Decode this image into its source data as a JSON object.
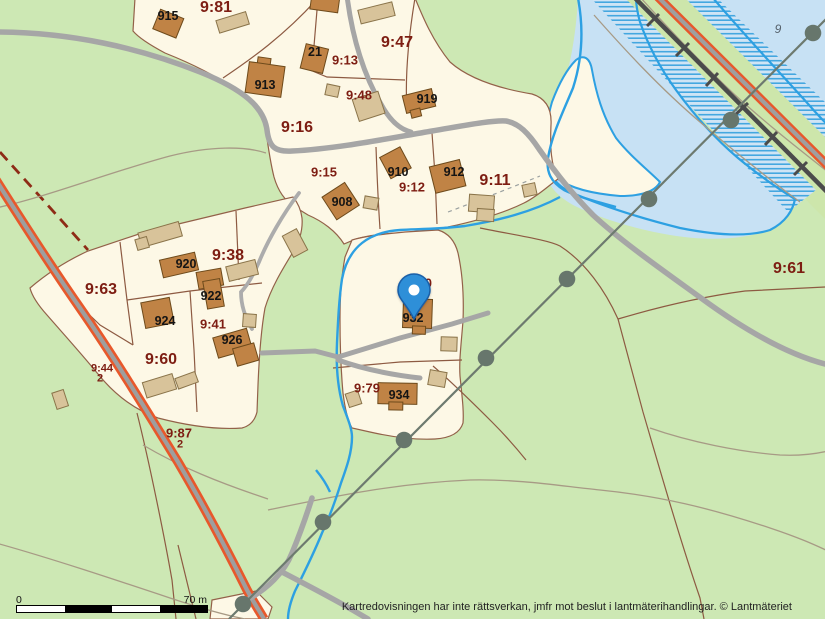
{
  "map": {
    "attribution": "Kartredovisningen har inte rättsverkan, jmfr mot beslut i lantmäterihandlingar. © Lantmäteriet",
    "scale_bar": {
      "start_label": "0",
      "end_label": "70 m"
    },
    "marker": {
      "type": "location-pin",
      "color": "#2e8fd8"
    },
    "colors": {
      "land_green": "#cde8b4",
      "parcel_cream": "#fdf8e6",
      "water": "#c7e1f4",
      "stream_blue": "#2da0e2",
      "house_brown": "#c08345",
      "outbuilding_beige": "#d8c39a",
      "road_gray": "#a6a6a6",
      "road_edge_orange": "#e8582b",
      "railway": "#4b4b4b",
      "parcel_text": "#7d1d12",
      "boundary_brown": "#8d5a42"
    },
    "labels": {
      "parcels": [
        {
          "text": "9:81",
          "x": 216,
          "y": 8,
          "size": "lg"
        },
        {
          "text": "9:47",
          "x": 397,
          "y": 43,
          "size": "lg"
        },
        {
          "text": "9:13",
          "x": 345,
          "y": 60,
          "size": "md"
        },
        {
          "text": "9:48",
          "x": 359,
          "y": 95,
          "size": "md"
        },
        {
          "text": "9:16",
          "x": 297,
          "y": 128,
          "size": "lg"
        },
        {
          "text": "9:15",
          "x": 324,
          "y": 172,
          "size": "md"
        },
        {
          "text": "9:12",
          "x": 412,
          "y": 187,
          "size": "md"
        },
        {
          "text": "9:11",
          "x": 495,
          "y": 181,
          "size": "lg"
        },
        {
          "text": "9:38",
          "x": 228,
          "y": 256,
          "size": "lg"
        },
        {
          "text": "9:63",
          "x": 101,
          "y": 290,
          "size": "lg"
        },
        {
          "text": "9:41",
          "x": 213,
          "y": 324,
          "size": "md"
        },
        {
          "text": "9:60",
          "x": 161,
          "y": 360,
          "size": "lg"
        },
        {
          "text": "9:44",
          "x": 102,
          "y": 369,
          "size": "sm"
        },
        {
          "text": "2",
          "x": 100,
          "y": 379,
          "size": "sm"
        },
        {
          "text": "9:87",
          "x": 179,
          "y": 433,
          "size": "md"
        },
        {
          "text": "2",
          "x": 180,
          "y": 445,
          "size": "sm"
        },
        {
          "text": "9:80",
          "x": 419,
          "y": 283,
          "size": "md"
        },
        {
          "text": "9:79",
          "x": 367,
          "y": 388,
          "size": "md"
        },
        {
          "text": "9:61",
          "x": 789,
          "y": 269,
          "size": "lg"
        }
      ],
      "buildings": [
        {
          "text": "915",
          "x": 168,
          "y": 16
        },
        {
          "text": "21",
          "x": 315,
          "y": 52
        },
        {
          "text": "913",
          "x": 265,
          "y": 85
        },
        {
          "text": "919",
          "x": 427,
          "y": 99
        },
        {
          "text": "908",
          "x": 342,
          "y": 202
        },
        {
          "text": "910",
          "x": 398,
          "y": 172
        },
        {
          "text": "912",
          "x": 454,
          "y": 172
        },
        {
          "text": "920",
          "x": 186,
          "y": 264
        },
        {
          "text": "922",
          "x": 211,
          "y": 296
        },
        {
          "text": "924",
          "x": 165,
          "y": 321
        },
        {
          "text": "926",
          "x": 232,
          "y": 340
        },
        {
          "text": "932",
          "x": 413,
          "y": 318
        },
        {
          "text": "934",
          "x": 399,
          "y": 395
        }
      ],
      "district": {
        "text": "9",
        "x": 778,
        "y": 29
      }
    }
  }
}
